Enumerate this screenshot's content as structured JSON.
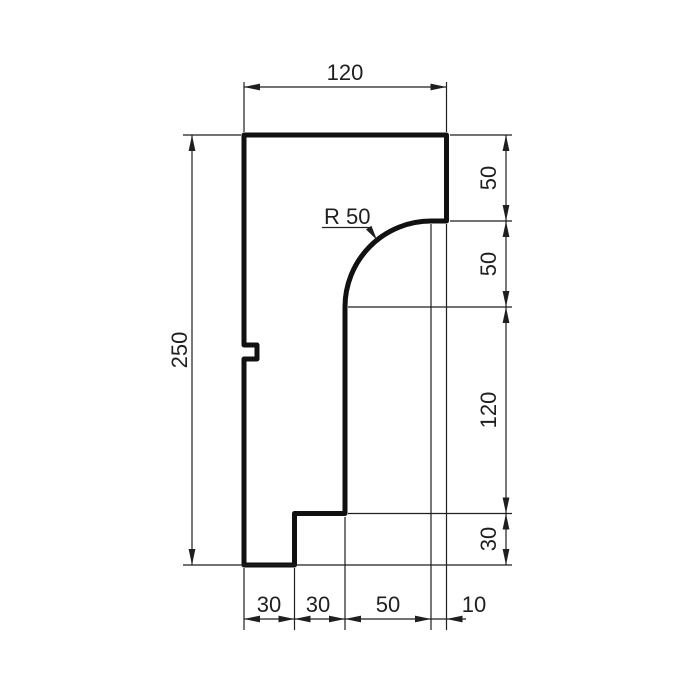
{
  "drawing": {
    "top_dim": "120",
    "left_dim": "250",
    "right_dims": [
      "50",
      "50",
      "120",
      "30"
    ],
    "bottom_dims": [
      "30",
      "30",
      "50",
      "10"
    ],
    "radius_label": "R 50",
    "colors": {
      "profile_line": "#111111",
      "dimension_line": "#1f1f1f",
      "text": "#1f1f1f",
      "background": "#ffffff"
    }
  }
}
